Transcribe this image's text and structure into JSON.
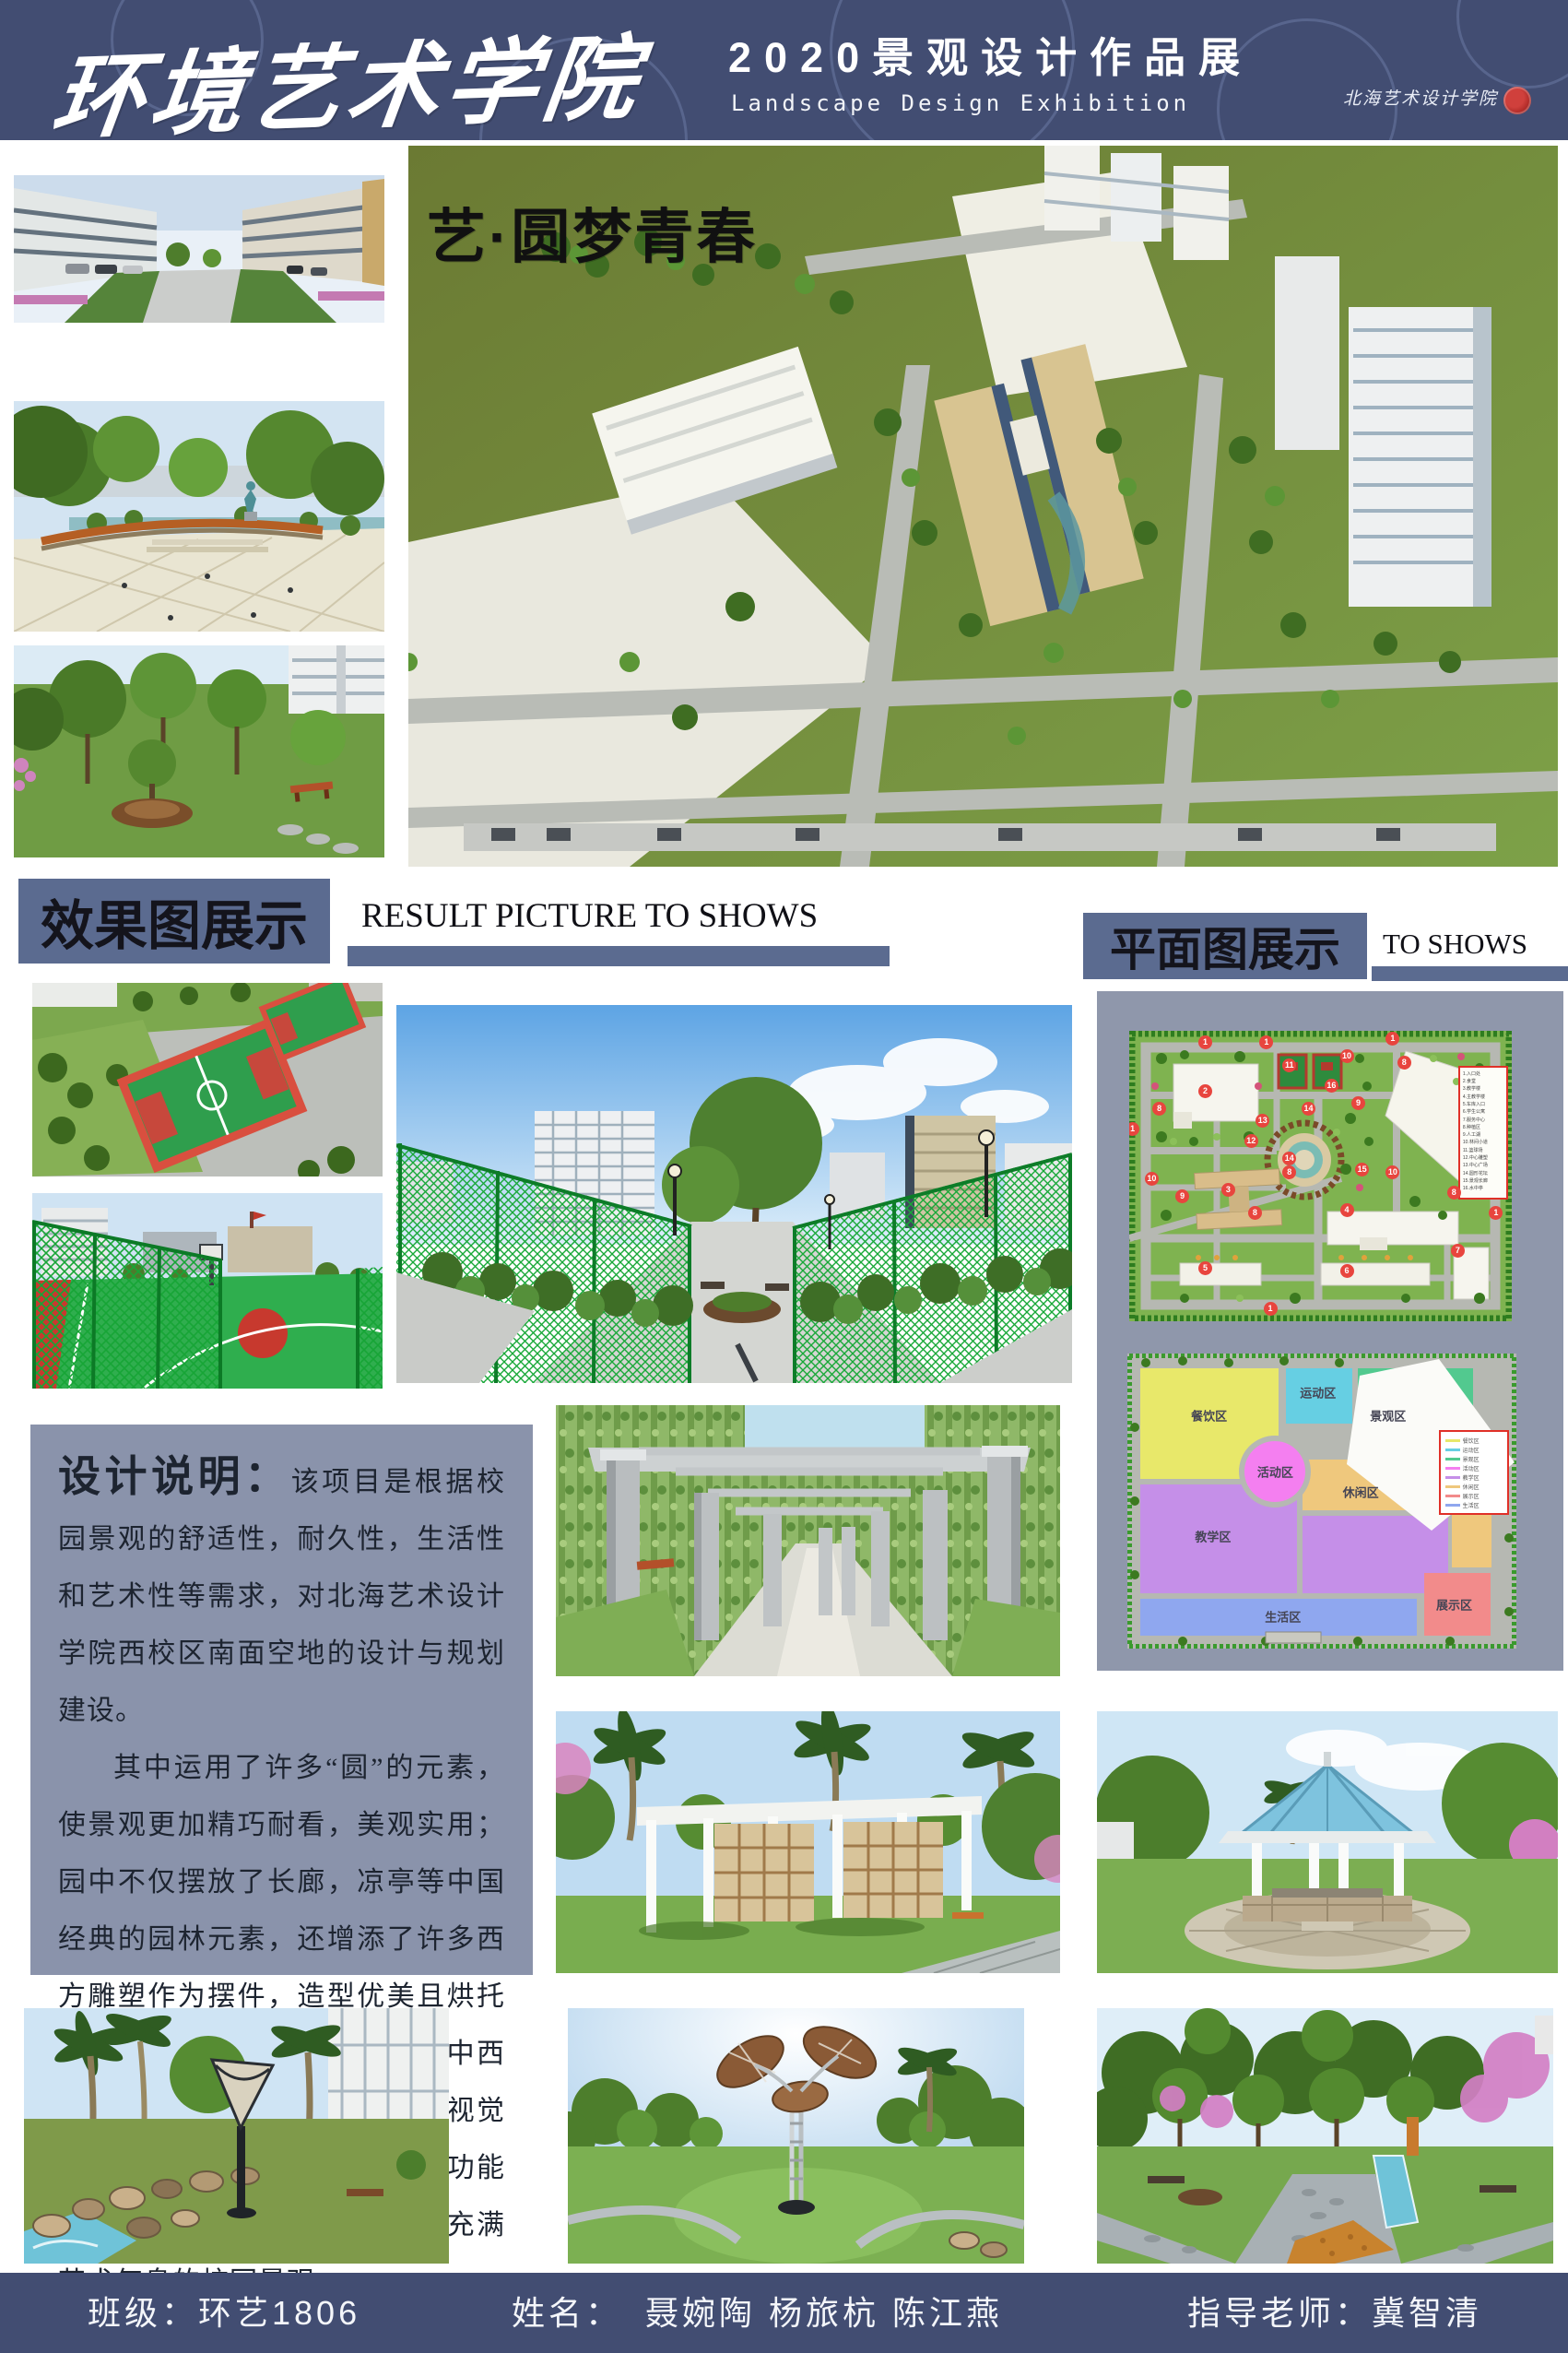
{
  "header": {
    "title": "环境艺术学院",
    "subtitle_cn": "2020景观设计作品展",
    "subtitle_en": "Landscape Design Exhibition",
    "seal_text": "北海艺术设计学院"
  },
  "hero": {
    "slogan": "艺·圆梦青春"
  },
  "sections": {
    "results": {
      "title_cn": "效果图展示",
      "title_en": "RESULT PICTURE TO SHOWS"
    },
    "plans": {
      "title_cn": "平面图展示",
      "title_en": "TO SHOWS"
    }
  },
  "design_note": {
    "label": "设计说明：",
    "para1": "该项目是根据校园景观的舒适性，耐久性，生活性和艺术性等需求，对北海艺术设计学院西校区南面空地的设计与规划建设。",
    "para2": "其中运用了许多“圆”的元素，使景观更加精巧耐看，美观实用；园中不仅摆放了长廊，凉亭等中国经典的园林元素，还增添了许多西方雕塑作为摆件，造型优美且烘托了校园的艺术气息；并且采用中西结合的方式给人们带来丰富的视觉体验。打造了一个布局合理，功能齐全，交通便利，环境优美且充满艺术气息的校园景观。"
  },
  "site_plan": {
    "legend_items": [
      "1.入口处",
      "2.食堂",
      "3.教学楼",
      "4.主教学楼",
      "5.车库入口",
      "6.学生公寓",
      "7.服务中心",
      "8.种植区",
      "9.人工湖",
      "10.林间小道",
      "11.篮球场",
      "12.中心雕塑",
      "13.中心广场",
      "14.圆形花坛",
      "15.景观长廊",
      "16.水中亭"
    ],
    "markers": [
      {
        "n": "1",
        "x": 20,
        "y": 4
      },
      {
        "n": "1",
        "x": 36,
        "y": 4
      },
      {
        "n": "1",
        "x": 69,
        "y": 3
      },
      {
        "n": "1",
        "x": 1,
        "y": 34
      },
      {
        "n": "1",
        "x": 96,
        "y": 63
      },
      {
        "n": "1",
        "x": 37,
        "y": 96
      },
      {
        "n": "2",
        "x": 20,
        "y": 21
      },
      {
        "n": "3",
        "x": 26,
        "y": 55
      },
      {
        "n": "4",
        "x": 57,
        "y": 62
      },
      {
        "n": "5",
        "x": 20,
        "y": 82
      },
      {
        "n": "6",
        "x": 57,
        "y": 83
      },
      {
        "n": "7",
        "x": 86,
        "y": 76
      },
      {
        "n": "8",
        "x": 8,
        "y": 27
      },
      {
        "n": "8",
        "x": 72,
        "y": 11
      },
      {
        "n": "8",
        "x": 42,
        "y": 49
      },
      {
        "n": "8",
        "x": 33,
        "y": 63
      },
      {
        "n": "8",
        "x": 85,
        "y": 56
      },
      {
        "n": "9",
        "x": 60,
        "y": 25
      },
      {
        "n": "9",
        "x": 14,
        "y": 57
      },
      {
        "n": "10",
        "x": 57,
        "y": 9
      },
      {
        "n": "10",
        "x": 6,
        "y": 51
      },
      {
        "n": "10",
        "x": 69,
        "y": 49
      },
      {
        "n": "11",
        "x": 42,
        "y": 12
      },
      {
        "n": "12",
        "x": 32,
        "y": 38
      },
      {
        "n": "13",
        "x": 35,
        "y": 31
      },
      {
        "n": "14",
        "x": 47,
        "y": 27
      },
      {
        "n": "14",
        "x": 42,
        "y": 44
      },
      {
        "n": "15",
        "x": 61,
        "y": 48
      },
      {
        "n": "16",
        "x": 53,
        "y": 19
      }
    ]
  },
  "zoning": {
    "zones": [
      {
        "label": "餐饮区",
        "color": "#e8e86a"
      },
      {
        "label": "运动区",
        "color": "#66cfe3"
      },
      {
        "label": "景观区",
        "color": "#52c98f"
      },
      {
        "label": "活动区",
        "color": "#f47ff0"
      },
      {
        "label": "教学区",
        "color": "#c58fe8"
      },
      {
        "label": "休闲区",
        "color": "#efc87d"
      },
      {
        "label": "展示区",
        "color": "#f28b8b"
      },
      {
        "label": "生活区",
        "color": "#8fa7ef"
      }
    ]
  },
  "footer": {
    "class_label": "班级：环艺1806",
    "name_label": "姓名：",
    "names": "聂婉陶  杨旅杭  陈江燕",
    "teacher_label": "指导老师：冀智清"
  }
}
